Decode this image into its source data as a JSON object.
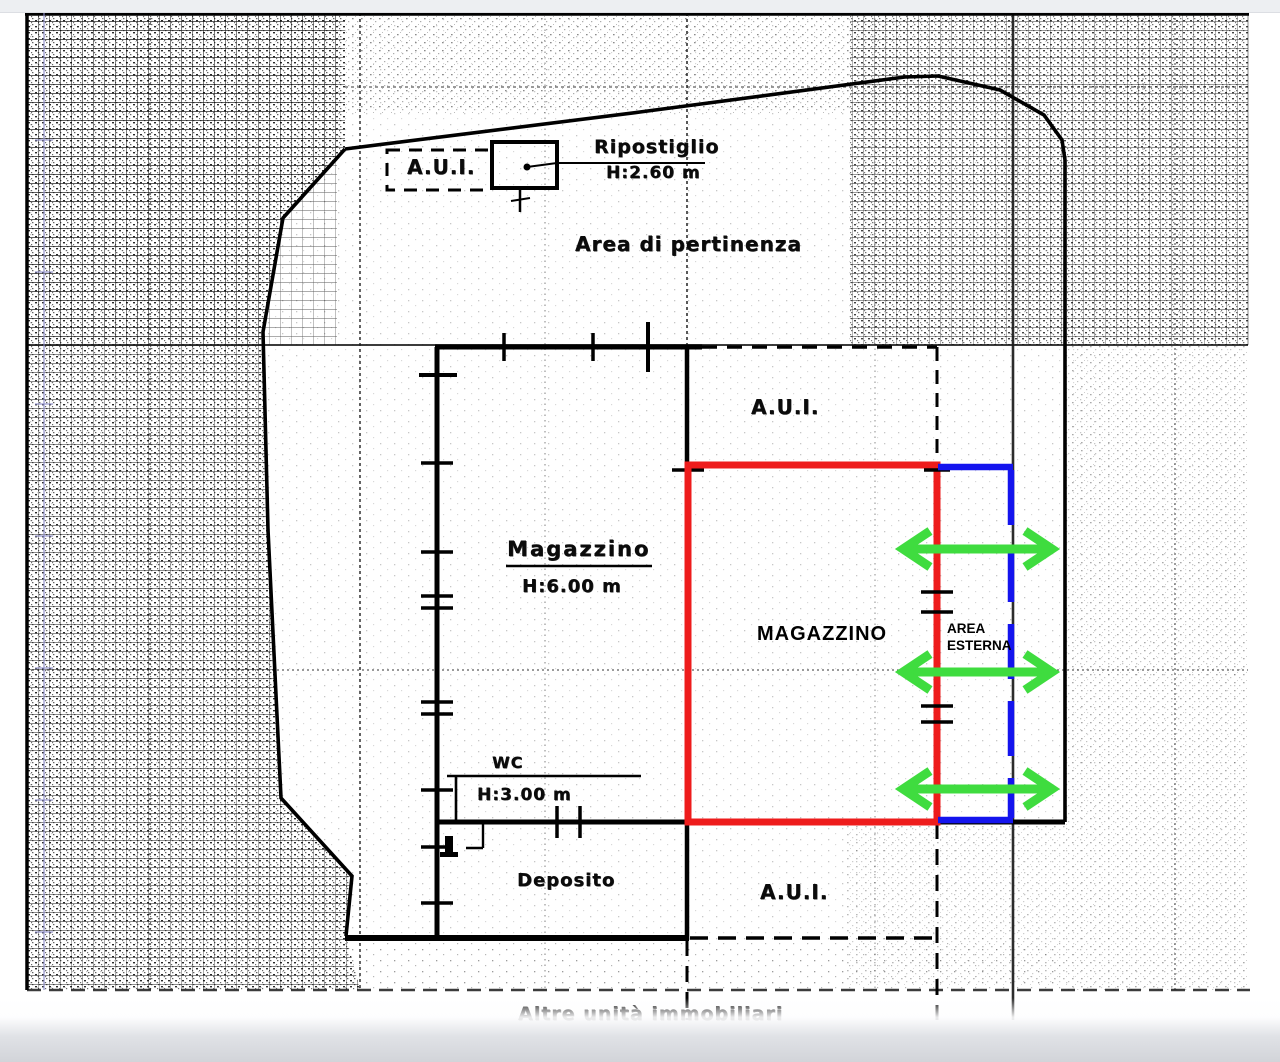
{
  "labels": {
    "aui_top": "A.U.I.",
    "ripostiglio": "Ripostiglio",
    "ripostiglio_height": "H:2.60 m",
    "area_pertinenza": "Area di pertinenza",
    "aui_upper": "A.U.I.",
    "magazzino": "Magazzino",
    "magazzino_height": "H:6.00 m",
    "magazzino_overlay": "MAGAZZINO",
    "area_esterna_line1": "AREA",
    "area_esterna_line2": "ESTERNA",
    "wc": "WC",
    "wc_height": "H:3.00 m",
    "deposito": "Deposito",
    "aui_lower": "A.U.I.",
    "bottom_partial": "Altre unità immobiliari"
  },
  "colors": {
    "highlight_red": "#ee1c1c",
    "boundary_blue": "#1414ee",
    "arrow_green": "#3fdc3f",
    "ink": "#111111"
  }
}
